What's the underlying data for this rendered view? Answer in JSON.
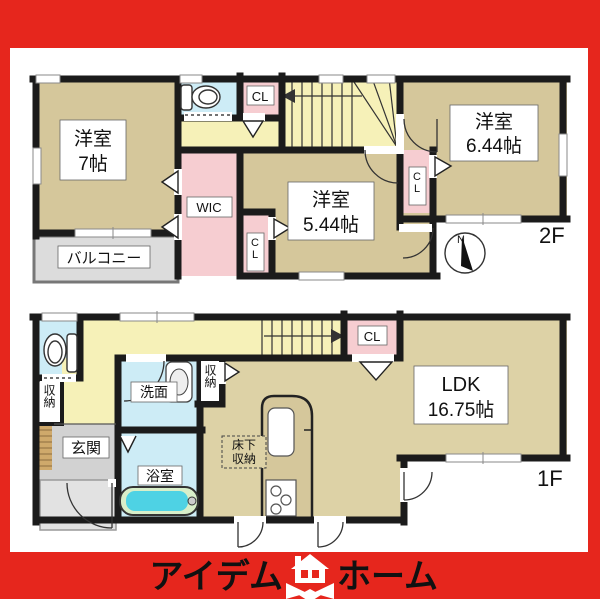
{
  "brand": {
    "logo_left": "アイデム",
    "logo_right": "ホーム",
    "banner_color": "#e6261d"
  },
  "colors": {
    "wall": "#1b1b1b",
    "room_tan": "#d5c79b",
    "hall_yellow": "#f6f1b8",
    "closet_pink": "#f6cdd1",
    "wet_blue": "#cdecf6",
    "balcony_gray": "#dcdcdc",
    "tub_cyan": "#4ed2e4"
  },
  "floor2": {
    "label": "2F",
    "compass": "N",
    "rooms": {
      "yoshitsu7": {
        "name": "洋室",
        "size": "7帖"
      },
      "yoshitsu544": {
        "name": "洋室",
        "size": "5.44帖"
      },
      "yoshitsu644": {
        "name": "洋室",
        "size": "6.44帖"
      },
      "wic": "WIC",
      "cl_top": "CL",
      "cl_mid": "CL",
      "cl_right": "CL",
      "balcony": "バルコニー"
    }
  },
  "floor1": {
    "label": "1F",
    "rooms": {
      "ldk": {
        "name": "LDK",
        "size": "16.75帖"
      },
      "genkan": "玄関",
      "senmen": "洗面",
      "yokushitsu": "浴室",
      "shuno_left": "収納",
      "shuno_mid": "収納",
      "yukashita": {
        "line1": "床下",
        "line2": "収納"
      },
      "cl": "CL"
    }
  }
}
